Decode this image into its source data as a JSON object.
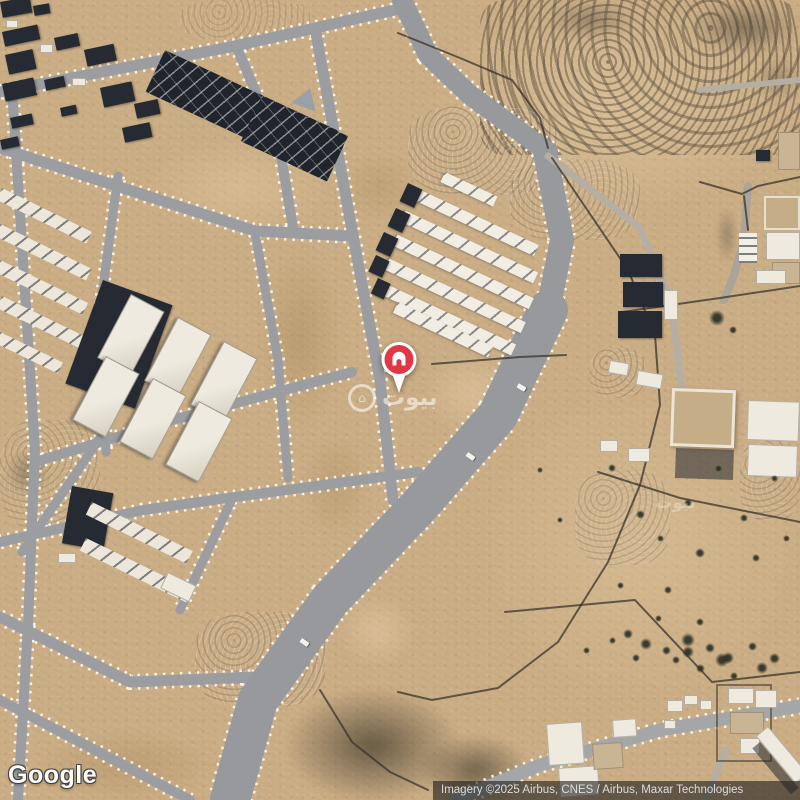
{
  "map": {
    "type": "satellite"
  },
  "marker": {
    "icon": "home-pin",
    "color": "#E23744"
  },
  "watermark": {
    "text": "بيوت"
  },
  "branding": {
    "logo_text": "Google"
  },
  "attribution": {
    "text": "Imagery ©2025 Airbus, CNES / Airbus, Maxar Technologies"
  },
  "colors": {
    "sand_base": "#CBAE85",
    "road_gray": "#9B9DA0",
    "road_wide": "#97999D",
    "building_dark": "#262B33",
    "building_white": "#EFEADF",
    "building_tan": "#C9B593",
    "rock_dark": "#5B5347",
    "wall": "#3A342C",
    "marker_red": "#E23744",
    "marker_white": "#FFFFFF",
    "attribution_bg": "#1C1C1C",
    "attribution_text": "#DCDCDC",
    "logo_text": "#FFFFFF",
    "watermark_white": "#FFFFFF"
  }
}
